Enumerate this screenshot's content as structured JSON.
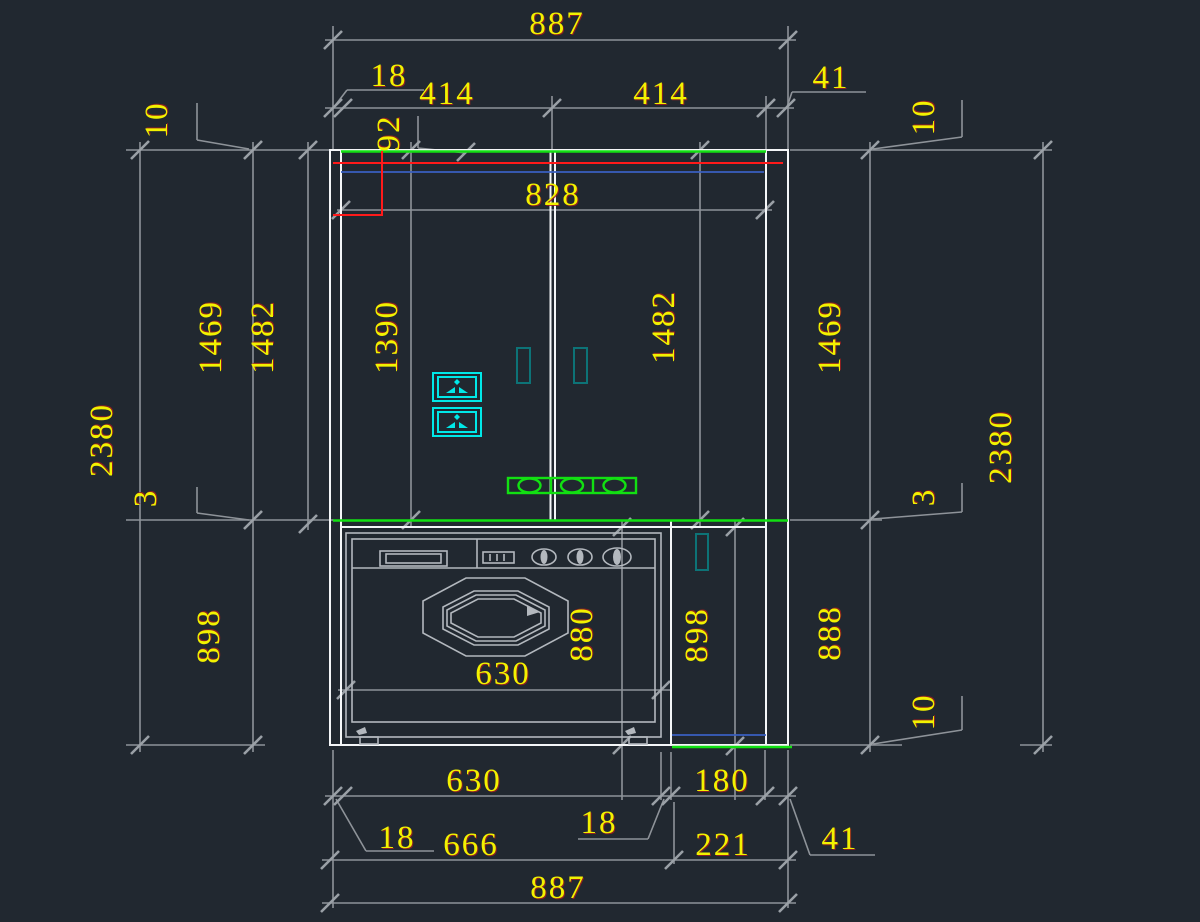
{
  "drawing": {
    "title": "cabinet-elevation-cad-drawing",
    "colors": {
      "bg": "#212830",
      "dim": "#8e9399",
      "dimtext": "#f2f200",
      "wall": "#f4f6f8",
      "washer": "#b3b8be",
      "red": "#ff1a1a",
      "green": "#12e012",
      "blue": "#3a5fc0",
      "cyan": "#00e8e8",
      "teal": "#0d7377"
    },
    "dims": {
      "top_overall": "887",
      "top_left_thickness": "18",
      "top_right_thickness": "41",
      "top_panel_left": "414",
      "top_panel_right": "414",
      "top_pipe_offset": "92",
      "top_inner_width": "828",
      "left_gap_top": "10",
      "left_upper_height": "1469",
      "left_upper_height_alt": "1482",
      "left_total_height": "2380",
      "left_counter_gap": "3",
      "left_lower_height": "898",
      "mid_door_height": "1390",
      "mid_door_height_right": "1482",
      "washer_door_width": "630",
      "washer_height": "880",
      "mid_lower_height": "898",
      "right_gap_top": "10",
      "right_upper_height": "1469",
      "right_total_height": "2380",
      "right_counter_gap": "3",
      "right_lower_height": "888",
      "right_gap_bottom": "10",
      "bottom_washer_width": "630",
      "bottom_right_width": "180",
      "bottom_left_thickness": "18",
      "bottom_mid_thickness": "18",
      "bottom_right_thickness": "41",
      "bottom_left_span": "666",
      "bottom_right_span": "221",
      "bottom_overall": "887"
    }
  }
}
